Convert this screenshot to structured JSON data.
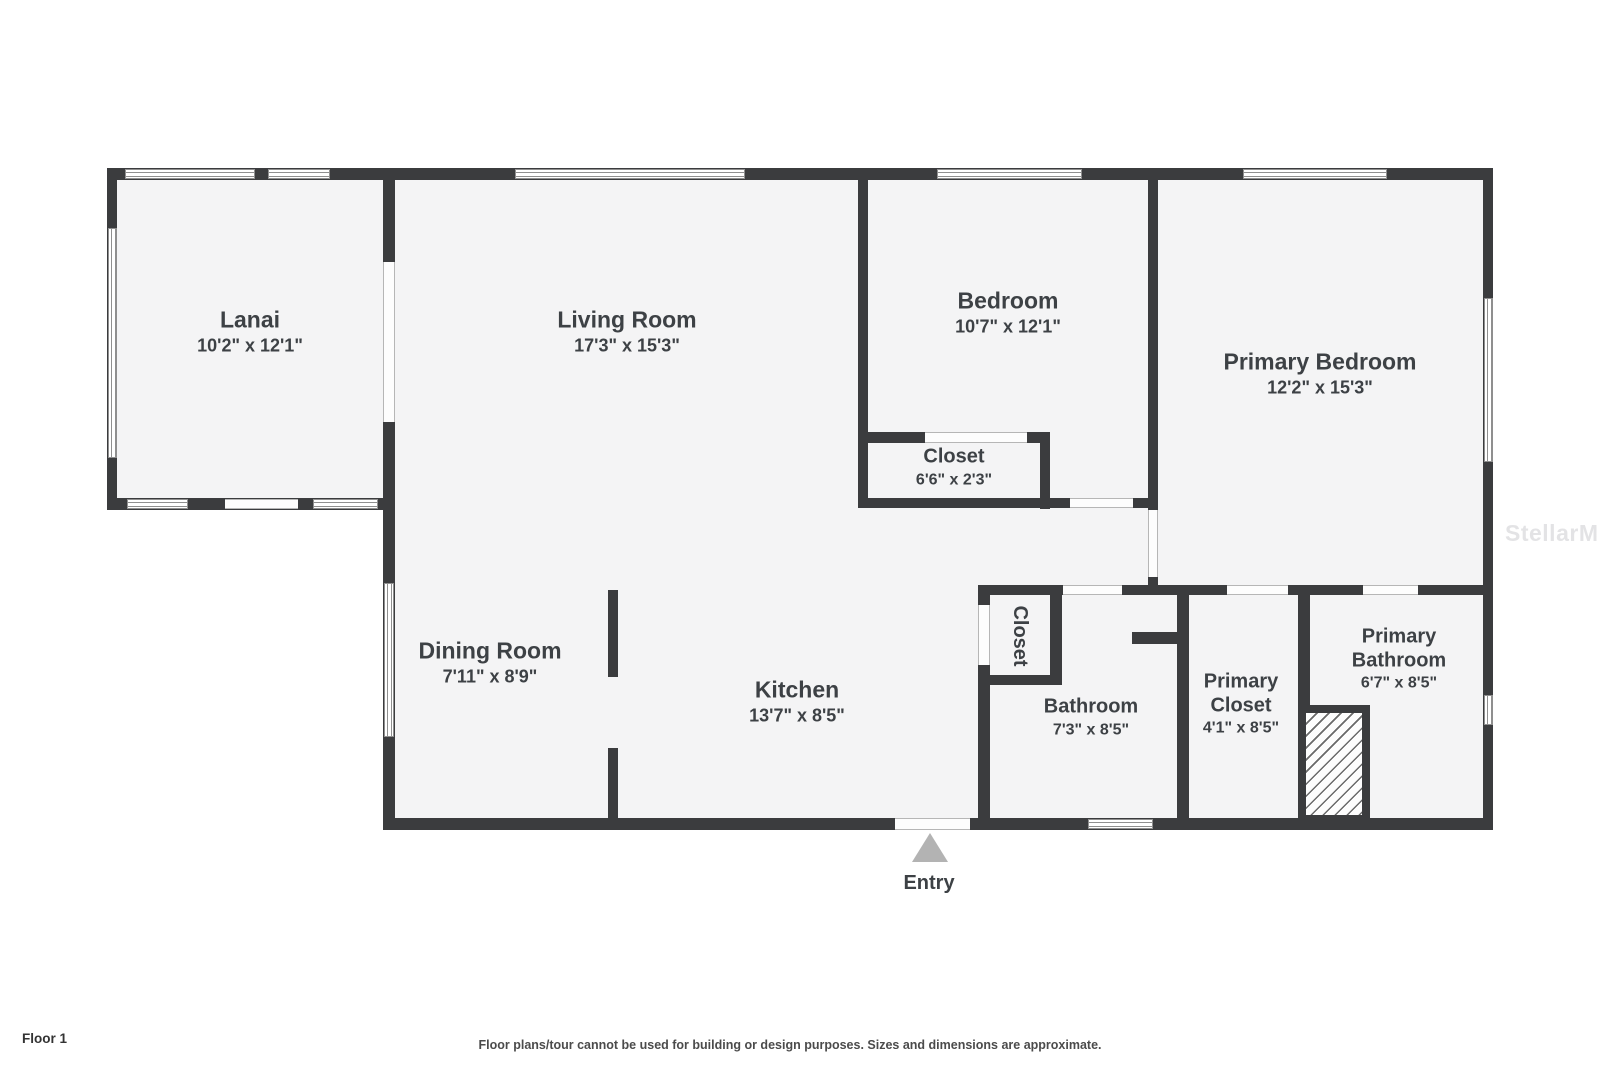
{
  "floorplan": {
    "floor_label": "Floor 1",
    "disclaimer": "Floor plans/tour cannot be used for building or design purposes. Sizes and dimensions are approximate.",
    "watermark": "StellarMLS",
    "entry_label": "Entry",
    "rooms": {
      "lanai": {
        "name": "Lanai",
        "dims": "10'2\" x 12'1\""
      },
      "living": {
        "name": "Living Room",
        "dims": "17'3\" x 15'3\""
      },
      "bedroom": {
        "name": "Bedroom",
        "dims": "10'7\" x 12'1\""
      },
      "primary_bedroom": {
        "name": "Primary Bedroom",
        "dims": "12'2\" x 15'3\""
      },
      "bedroom_closet": {
        "name": "Closet",
        "dims": "6'6\" x 2'3\""
      },
      "dining": {
        "name": "Dining Room",
        "dims": "7'11\" x 8'9\""
      },
      "kitchen": {
        "name": "Kitchen",
        "dims": "13'7\" x 8'5\""
      },
      "hall_closet": {
        "name": "Closet"
      },
      "bathroom": {
        "name": "Bathroom",
        "dims": "7'3\" x 8'5\""
      },
      "primary_closet": {
        "name": "Primary Closet",
        "dims": "4'1\" x 8'5\""
      },
      "primary_bathroom": {
        "name": "Primary Bathroom",
        "dims": "6'7\" x 8'5\""
      }
    },
    "colors": {
      "wall": "#3b3c3e",
      "room_fill": "#f4f4f5",
      "label_text": "#3d4145",
      "window_frame": "#8f8f8f",
      "entry_arrow": "#b3b3b3"
    }
  }
}
